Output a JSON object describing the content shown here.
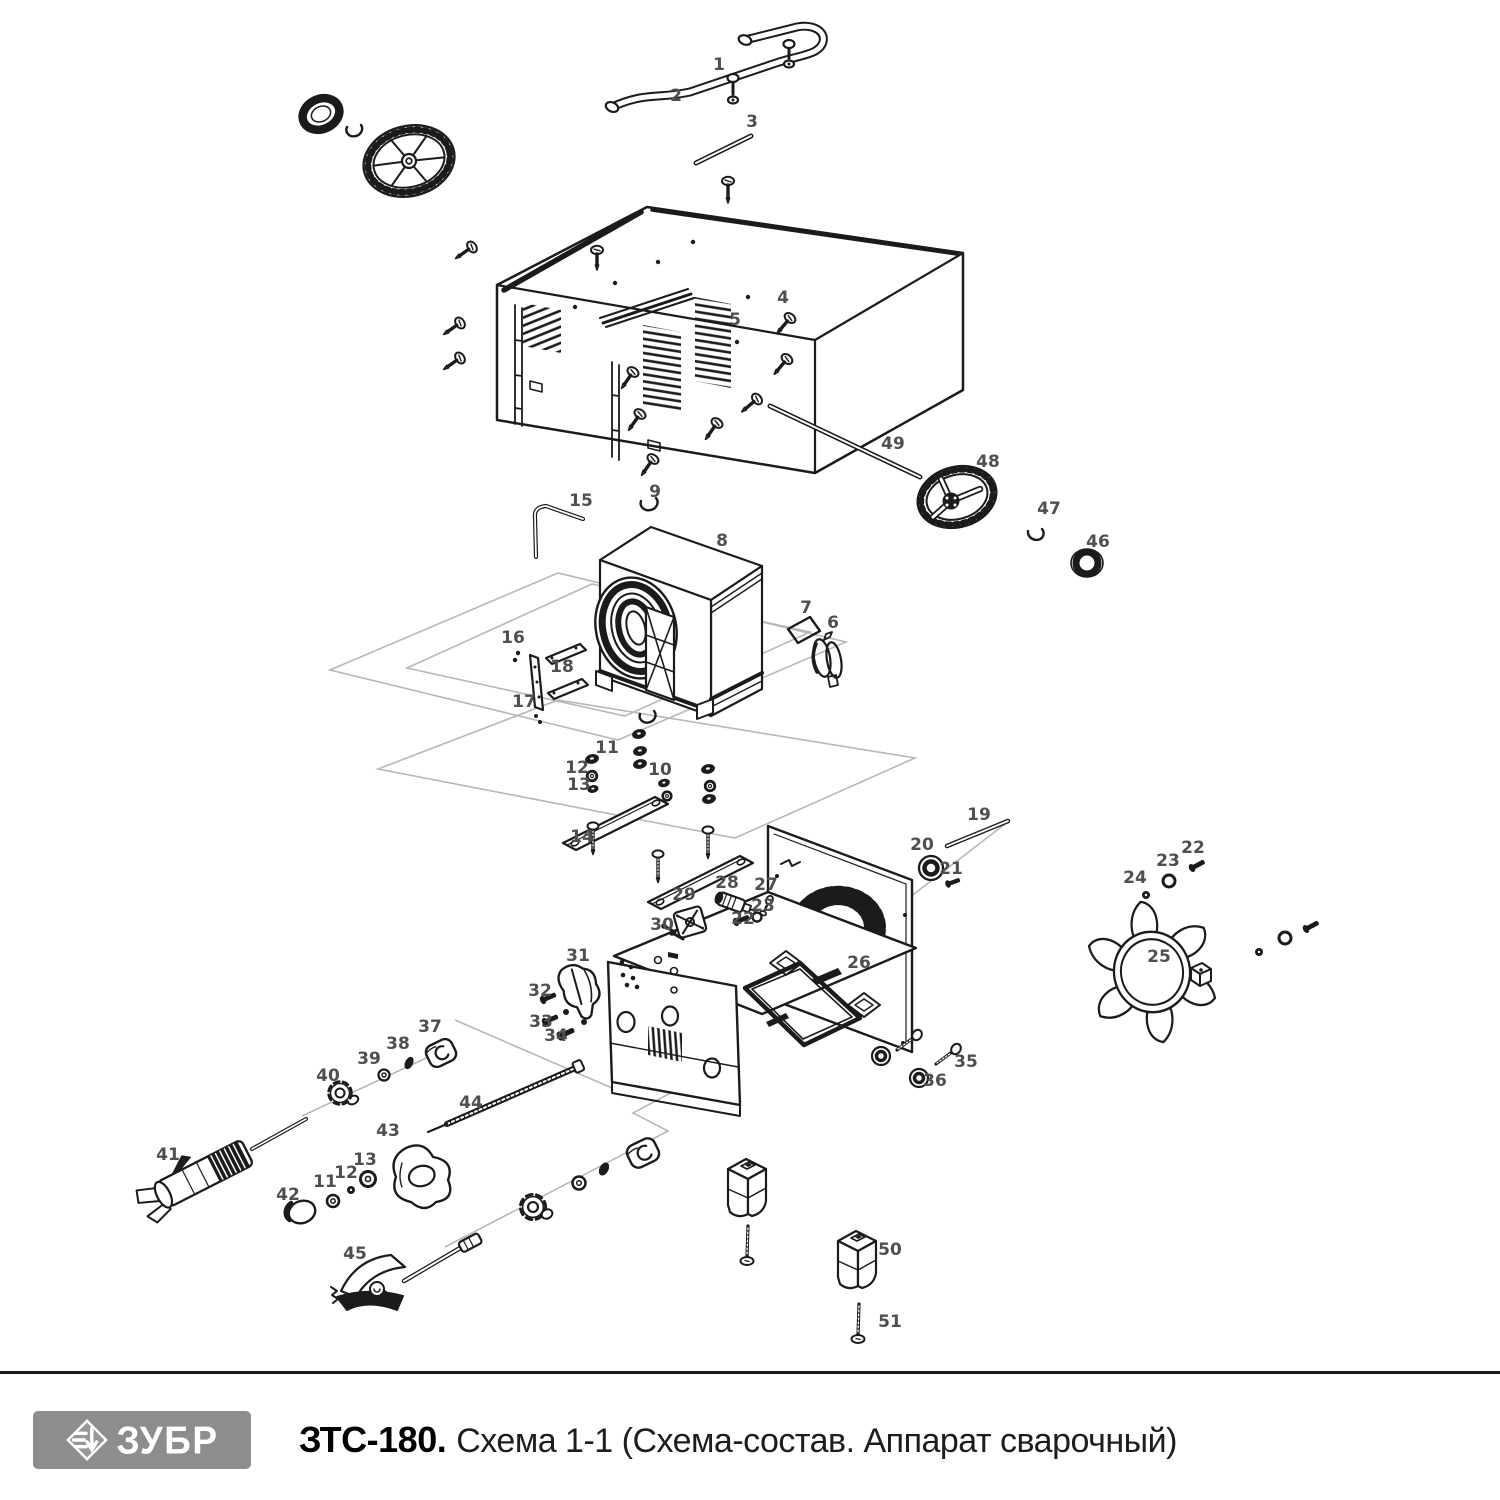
{
  "footer": {
    "brand": "ЗУБР",
    "model": "ЗТС-180.",
    "subtitle": "Схема 1-1 (Схема-состав. Аппарат сварочный)"
  },
  "diagram": {
    "description": "Exploded view of welding machine with numbered parts",
    "line_color": "#1b1b1b",
    "label_color": "#4f4f4f",
    "guide_color": "#b8b8b8",
    "part_labels": [
      {
        "n": "1",
        "x": 719,
        "y": 70
      },
      {
        "n": "2",
        "x": 676,
        "y": 101
      },
      {
        "n": "3",
        "x": 752,
        "y": 127
      },
      {
        "n": "4",
        "x": 783,
        "y": 303
      },
      {
        "n": "5",
        "x": 735,
        "y": 325
      },
      {
        "n": "6",
        "x": 833,
        "y": 628
      },
      {
        "n": "7",
        "x": 806,
        "y": 613
      },
      {
        "n": "8",
        "x": 722,
        "y": 546
      },
      {
        "n": "9",
        "x": 655,
        "y": 497
      },
      {
        "n": "10",
        "x": 660,
        "y": 775
      },
      {
        "n": "11",
        "x": 607,
        "y": 753
      },
      {
        "n": "12",
        "x": 577,
        "y": 773
      },
      {
        "n": "13",
        "x": 579,
        "y": 790
      },
      {
        "n": "14",
        "x": 582,
        "y": 842
      },
      {
        "n": "15",
        "x": 581,
        "y": 506
      },
      {
        "n": "16",
        "x": 513,
        "y": 643
      },
      {
        "n": "17",
        "x": 524,
        "y": 707
      },
      {
        "n": "18",
        "x": 562,
        "y": 672
      },
      {
        "n": "19",
        "x": 979,
        "y": 820
      },
      {
        "n": "20",
        "x": 922,
        "y": 850
      },
      {
        "n": "21",
        "x": 951,
        "y": 874
      },
      {
        "n": "22",
        "x": 743,
        "y": 924
      },
      {
        "n": "23",
        "x": 763,
        "y": 911
      },
      {
        "n": "24",
        "x": 1135,
        "y": 883
      },
      {
        "n": "25",
        "x": 1159,
        "y": 962
      },
      {
        "n": "26",
        "x": 859,
        "y": 968
      },
      {
        "n": "27",
        "x": 766,
        "y": 890
      },
      {
        "n": "28",
        "x": 727,
        "y": 888
      },
      {
        "n": "29",
        "x": 684,
        "y": 900
      },
      {
        "n": "30",
        "x": 662,
        "y": 930
      },
      {
        "n": "31",
        "x": 578,
        "y": 961
      },
      {
        "n": "32",
        "x": 540,
        "y": 996
      },
      {
        "n": "33",
        "x": 541,
        "y": 1027
      },
      {
        "n": "34",
        "x": 556,
        "y": 1041
      },
      {
        "n": "35",
        "x": 966,
        "y": 1067
      },
      {
        "n": "36",
        "x": 935,
        "y": 1086
      },
      {
        "n": "37",
        "x": 430,
        "y": 1032
      },
      {
        "n": "38",
        "x": 398,
        "y": 1049
      },
      {
        "n": "39",
        "x": 369,
        "y": 1064
      },
      {
        "n": "40",
        "x": 328,
        "y": 1081
      },
      {
        "n": "41",
        "x": 168,
        "y": 1160
      },
      {
        "n": "42",
        "x": 288,
        "y": 1200
      },
      {
        "n": "43",
        "x": 388,
        "y": 1136
      },
      {
        "n": "44",
        "x": 471,
        "y": 1108
      },
      {
        "n": "45",
        "x": 355,
        "y": 1259
      },
      {
        "n": "46",
        "x": 1098,
        "y": 547
      },
      {
        "n": "47",
        "x": 1049,
        "y": 514
      },
      {
        "n": "48",
        "x": 988,
        "y": 467
      },
      {
        "n": "49",
        "x": 893,
        "y": 449
      },
      {
        "n": "50",
        "x": 890,
        "y": 1255
      },
      {
        "n": "51",
        "x": 890,
        "y": 1327
      },
      {
        "n": "22",
        "x": 1193,
        "y": 853
      },
      {
        "n": "23",
        "x": 1168,
        "y": 866
      },
      {
        "n": "11",
        "x": 325,
        "y": 1187
      },
      {
        "n": "12",
        "x": 346,
        "y": 1178
      },
      {
        "n": "13",
        "x": 365,
        "y": 1165
      }
    ]
  }
}
